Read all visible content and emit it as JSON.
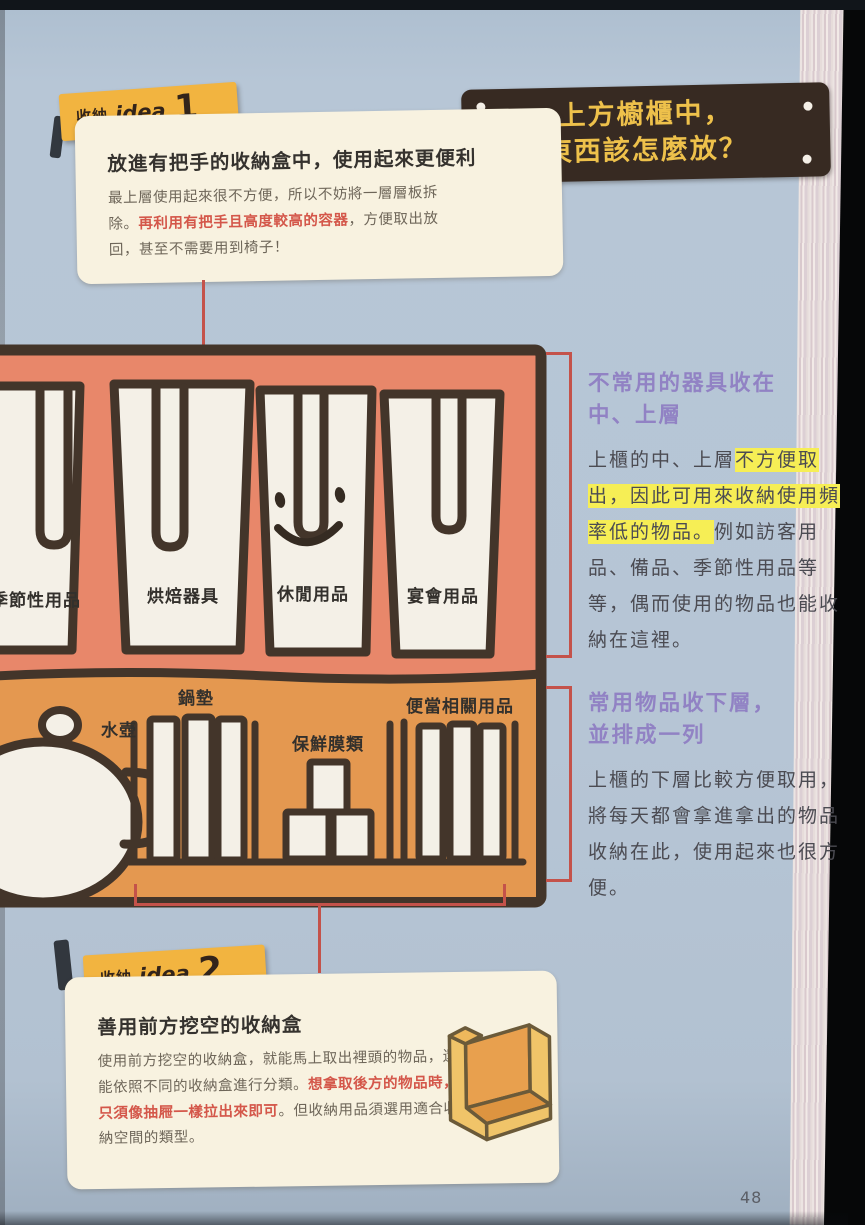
{
  "page": {
    "number": "48"
  },
  "badges": {
    "idea1": {
      "prefix": "收納",
      "word": "idea",
      "num": "1"
    },
    "idea2": {
      "prefix": "收納",
      "word": "idea",
      "num": "2"
    }
  },
  "title_sign": {
    "line1": "上方櫥櫃中，",
    "line2": "東西該怎麼放？"
  },
  "tip1": {
    "title": "放進有把手的收納盒中，使用起來更便利",
    "body_1": "最上層使用起來很不方便，所以不妨將一層層板拆除。",
    "body_red": "再利用有把手且高度較高的容器",
    "body_2": "，方便取出放回，甚至不需要用到椅子！"
  },
  "cabinet": {
    "upper_boxes": {
      "b1": "季節性用品",
      "b2": "烘焙器具",
      "b3": "休閒用品",
      "b4": "宴會用品"
    },
    "lower_items": {
      "kettle": "水壺",
      "potmats": "鍋墊",
      "wraps": "保鮮膜類",
      "bento": "便當相關用品"
    }
  },
  "note1": {
    "heading_1": "不常用的器具收在",
    "heading_2": "中、上層",
    "body_1": "上櫃的中、上層",
    "body_hl": "不方便取出，因此可用來收納使用頻率低的物品。",
    "body_2": "例如訪客用品、備品、季節性用品等等，偶而使用的物品也能收納在這裡。"
  },
  "note2": {
    "heading_1": "常用物品收下層，",
    "heading_2": "並排成一列",
    "body": "上櫃的下層比較方便取用，將每天都會拿進拿出的物品收納在此，使用起來也很方便。"
  },
  "tip2": {
    "title": "善用前方挖空的收納盒",
    "body_1": "使用前方挖空的收納盒，就能馬上取出裡頭的物品，還能依照不同的收納盒進行分類。",
    "body_red": "想拿取後方的物品時，只須像抽屜一樣拉出來即可",
    "body_2": "。但收納用品須選用適合收納空間的類型。"
  },
  "colors": {
    "page_blue": "#b6c5d5",
    "badge_yellow": "#f2b440",
    "sign_brown": "#372a22",
    "sign_text_yellow": "#eec14b",
    "tipbox_cream": "#f8f2e0",
    "upper_shelf_salmon": "#e8876a",
    "lower_shelf_orange": "#e49850",
    "outline_brown": "#43352a",
    "accent_red": "#c4524a",
    "heading_purple": "#9182c4",
    "highlight_yellow": "#f6ee55"
  }
}
